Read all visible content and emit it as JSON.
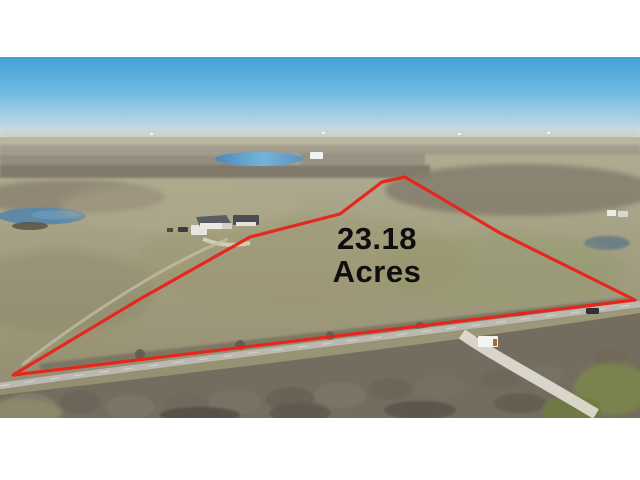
{
  "photo": {
    "description": "Aerial drone photograph of a rural land parcel outlined with a red boundary line, winter pastures, ponds, farm houses and a county road",
    "overlay": {
      "value": "23.18",
      "unit": "Acres",
      "text_color": "#0e0e0e",
      "boundary_color": "#e8231b"
    },
    "palette": {
      "letterbox": "#ffffff",
      "sky_top": "#41a0d5",
      "sky_horizon": "#dde6ea",
      "field": "#a5a184",
      "lake": "#5f9cc4",
      "winter_trees": "#766f61",
      "road": "#bab8af"
    }
  }
}
